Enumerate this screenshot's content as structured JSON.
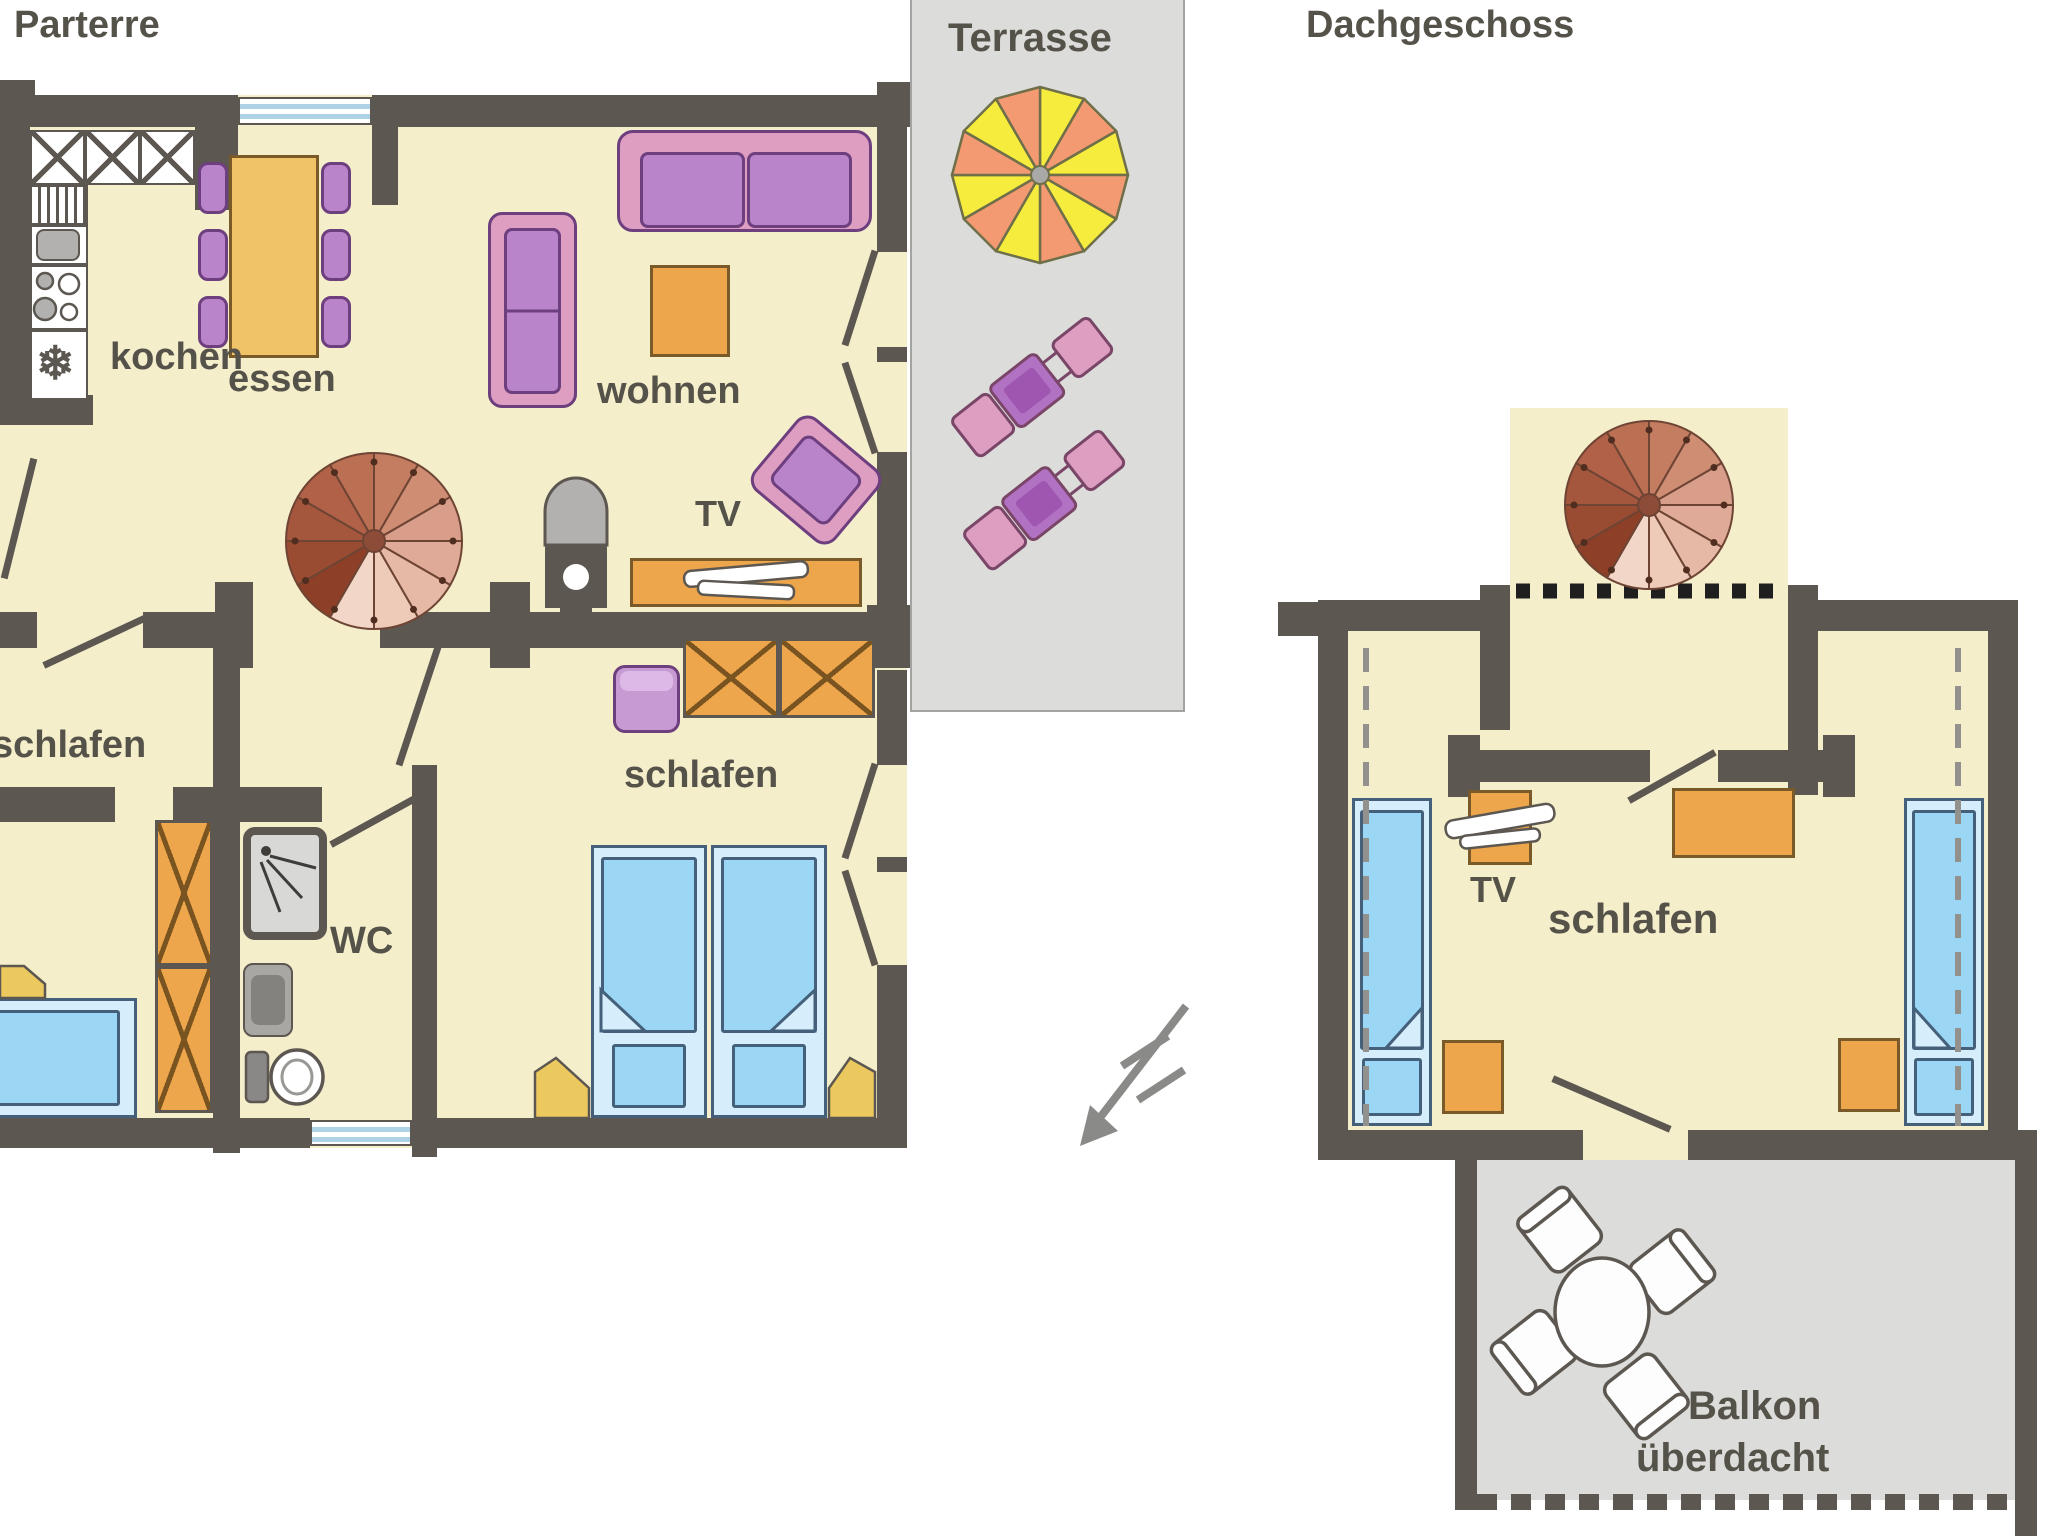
{
  "titles": {
    "parterre": "Parterre",
    "dachgeschoss": "Dachgeschoss"
  },
  "parterre": {
    "kitchen_label": "kochen",
    "dining_label": "essen",
    "living_label": "wohnen",
    "tv_label": "TV",
    "bedroom_left_label": "schlafen",
    "bedroom_right_label": "schlafen",
    "wc_label": "WC"
  },
  "terrace": {
    "label": "Terrasse"
  },
  "dachgeschoss": {
    "bedroom_label": "schlafen",
    "tv_label": "TV",
    "balcony_line1": "Balkon",
    "balcony_line2": "überdacht"
  },
  "icons": {
    "freezer": "❄"
  },
  "palette": {
    "wall": "#5d5751",
    "floor": "#f5eecb",
    "outdoor_gray": "#dcdcda",
    "text": "#55524a",
    "furniture_orange": "#eda64c",
    "furniture_purple": "#ba84ca",
    "furniture_pink": "#dd9ec2",
    "table_yellow": "#f0c368",
    "bed_blue": "#9cd6f5",
    "bed_frame_blue": "#d6edfb",
    "stair_brown": "#b06148",
    "parasol_yellow": "#f6ec3d",
    "parasol_orange": "#f39a72",
    "window_blue": "#aed2e6",
    "nightstand_yellow": "#ecc95f"
  }
}
